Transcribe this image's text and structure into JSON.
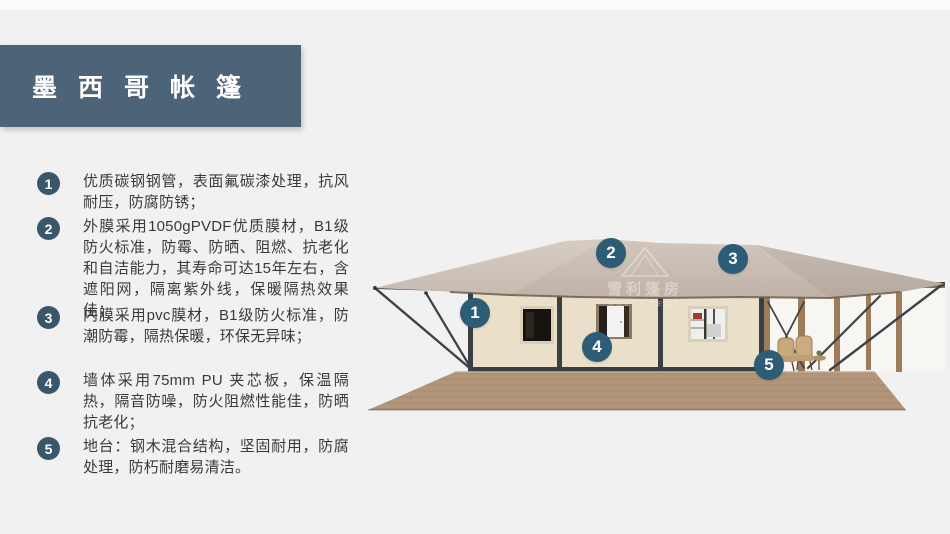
{
  "slide": {
    "title": "墨西哥帐篷",
    "features": [
      {
        "num": "1",
        "text": "优质碳钢钢管，表面氟碳漆处理，抗风耐压，防腐防锈；"
      },
      {
        "num": "2",
        "text": "外膜采用1050gPVDF优质膜材，B1级防火标准，防霉、防晒、阻燃、抗老化和自洁能力，其寿命可达15年左右，含遮阳网，隔离紫外线，保暖隔热效果佳；"
      },
      {
        "num": "3",
        "text": "内膜采用pvc膜材，B1级防火标准，防潮防霉，隔热保暖，环保无异味；"
      },
      {
        "num": "4",
        "text": "墙体采用75mm PU 夹芯板，保温隔热，隔音防噪，防火阻燃性能佳，防晒抗老化；"
      },
      {
        "num": "5",
        "text": "地台：钢木混合结构，坚固耐用，防腐处理，防朽耐磨易清洁。"
      }
    ],
    "callouts": [
      {
        "num": "1"
      },
      {
        "num": "2"
      },
      {
        "num": "3"
      },
      {
        "num": "4"
      },
      {
        "num": "5"
      }
    ],
    "watermark": {
      "line1": "雪利篷房",
      "line2": "XUELI TENT"
    },
    "colors": {
      "background": "#f1f1f2",
      "banner": "#4d6377",
      "feature_badge": "#3a566b",
      "callout_badge": "#2d5d76",
      "roof_fabric": "#c9bbb1",
      "wall_panel": "#eadfc9",
      "steel_frame": "#3f444a",
      "wood": "#9b7b5c",
      "deck": "#b2957a"
    }
  }
}
